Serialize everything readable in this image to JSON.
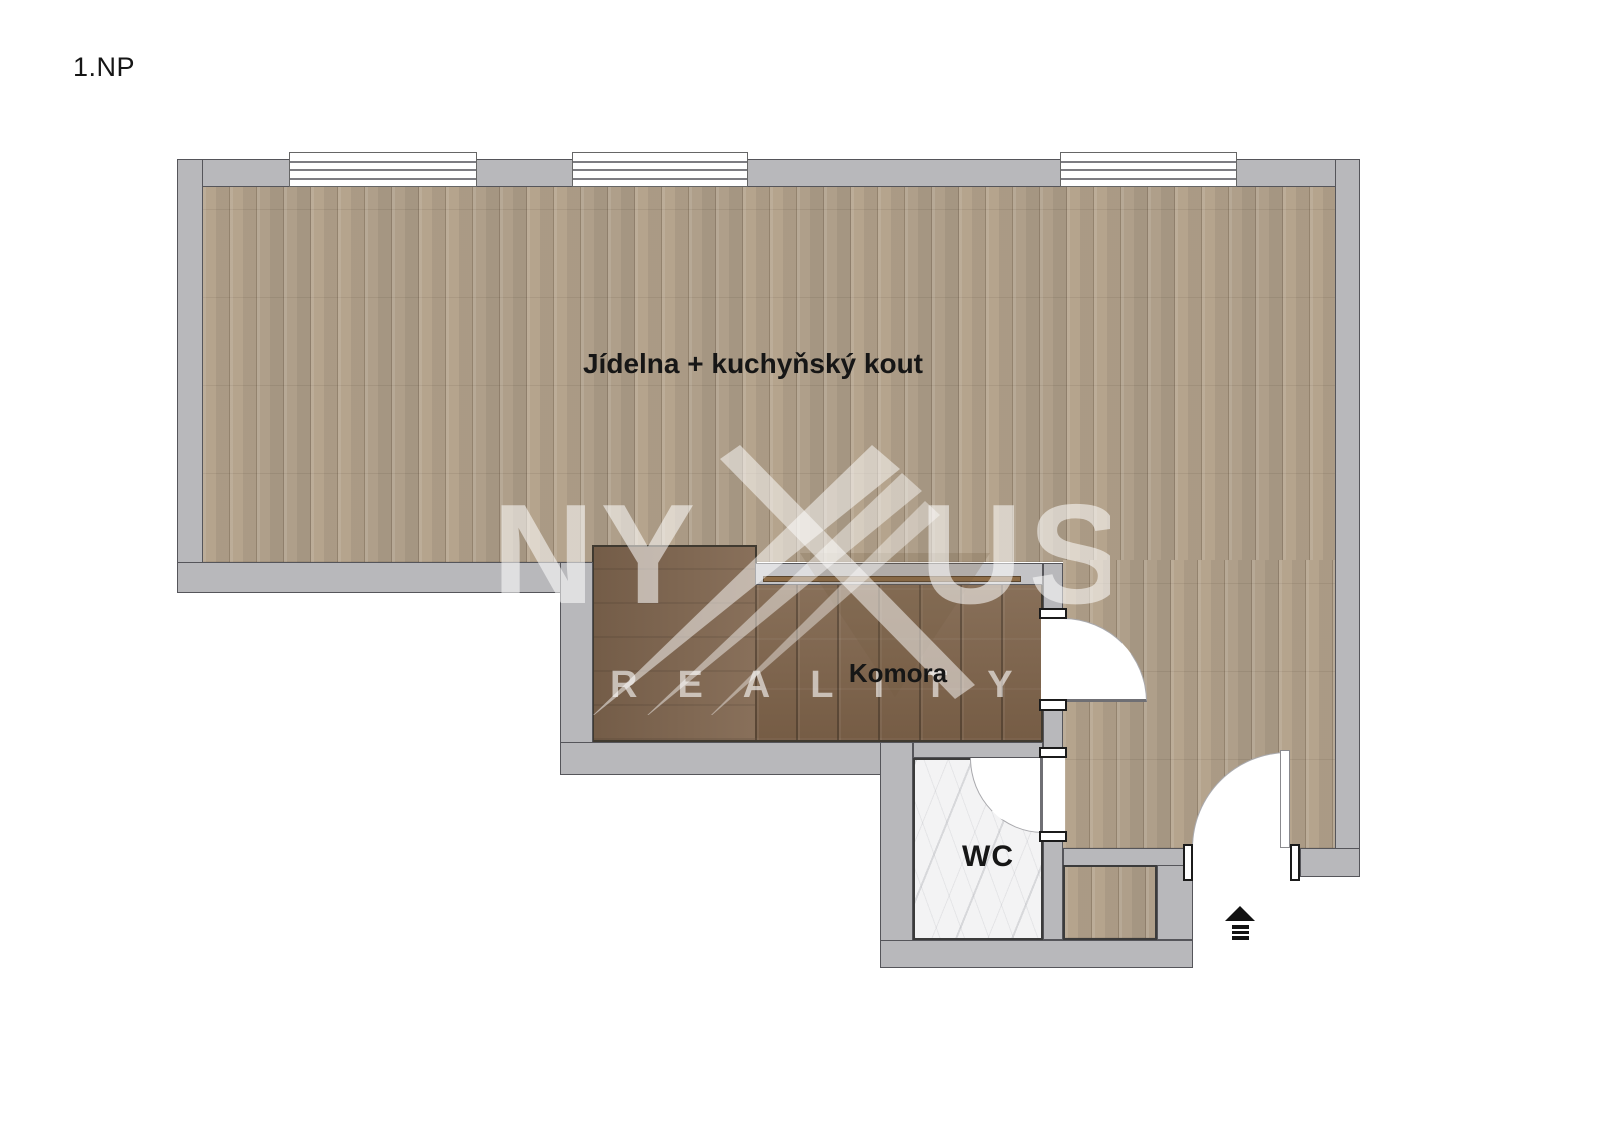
{
  "page": {
    "background": "#ffffff"
  },
  "title": {
    "floor_label": "1.NP"
  },
  "rooms": {
    "dining_label": "Jídelna + kuchyňský kout",
    "pantry_label": "Komora",
    "wc_label": "WC"
  },
  "watermark": {
    "brand_left": "NY",
    "brand_right": "US",
    "tagline": "REALITY"
  },
  "icons": {
    "entrance_arrow": "▲"
  },
  "colors": {
    "wall": "#b8b8bb",
    "wall_outline": "#55555a",
    "floor_light": "#bcab94",
    "floor_dark": "#7d6249",
    "marble": "#f3f3f4",
    "ink": "#161616",
    "counter": "#8d6c47"
  }
}
